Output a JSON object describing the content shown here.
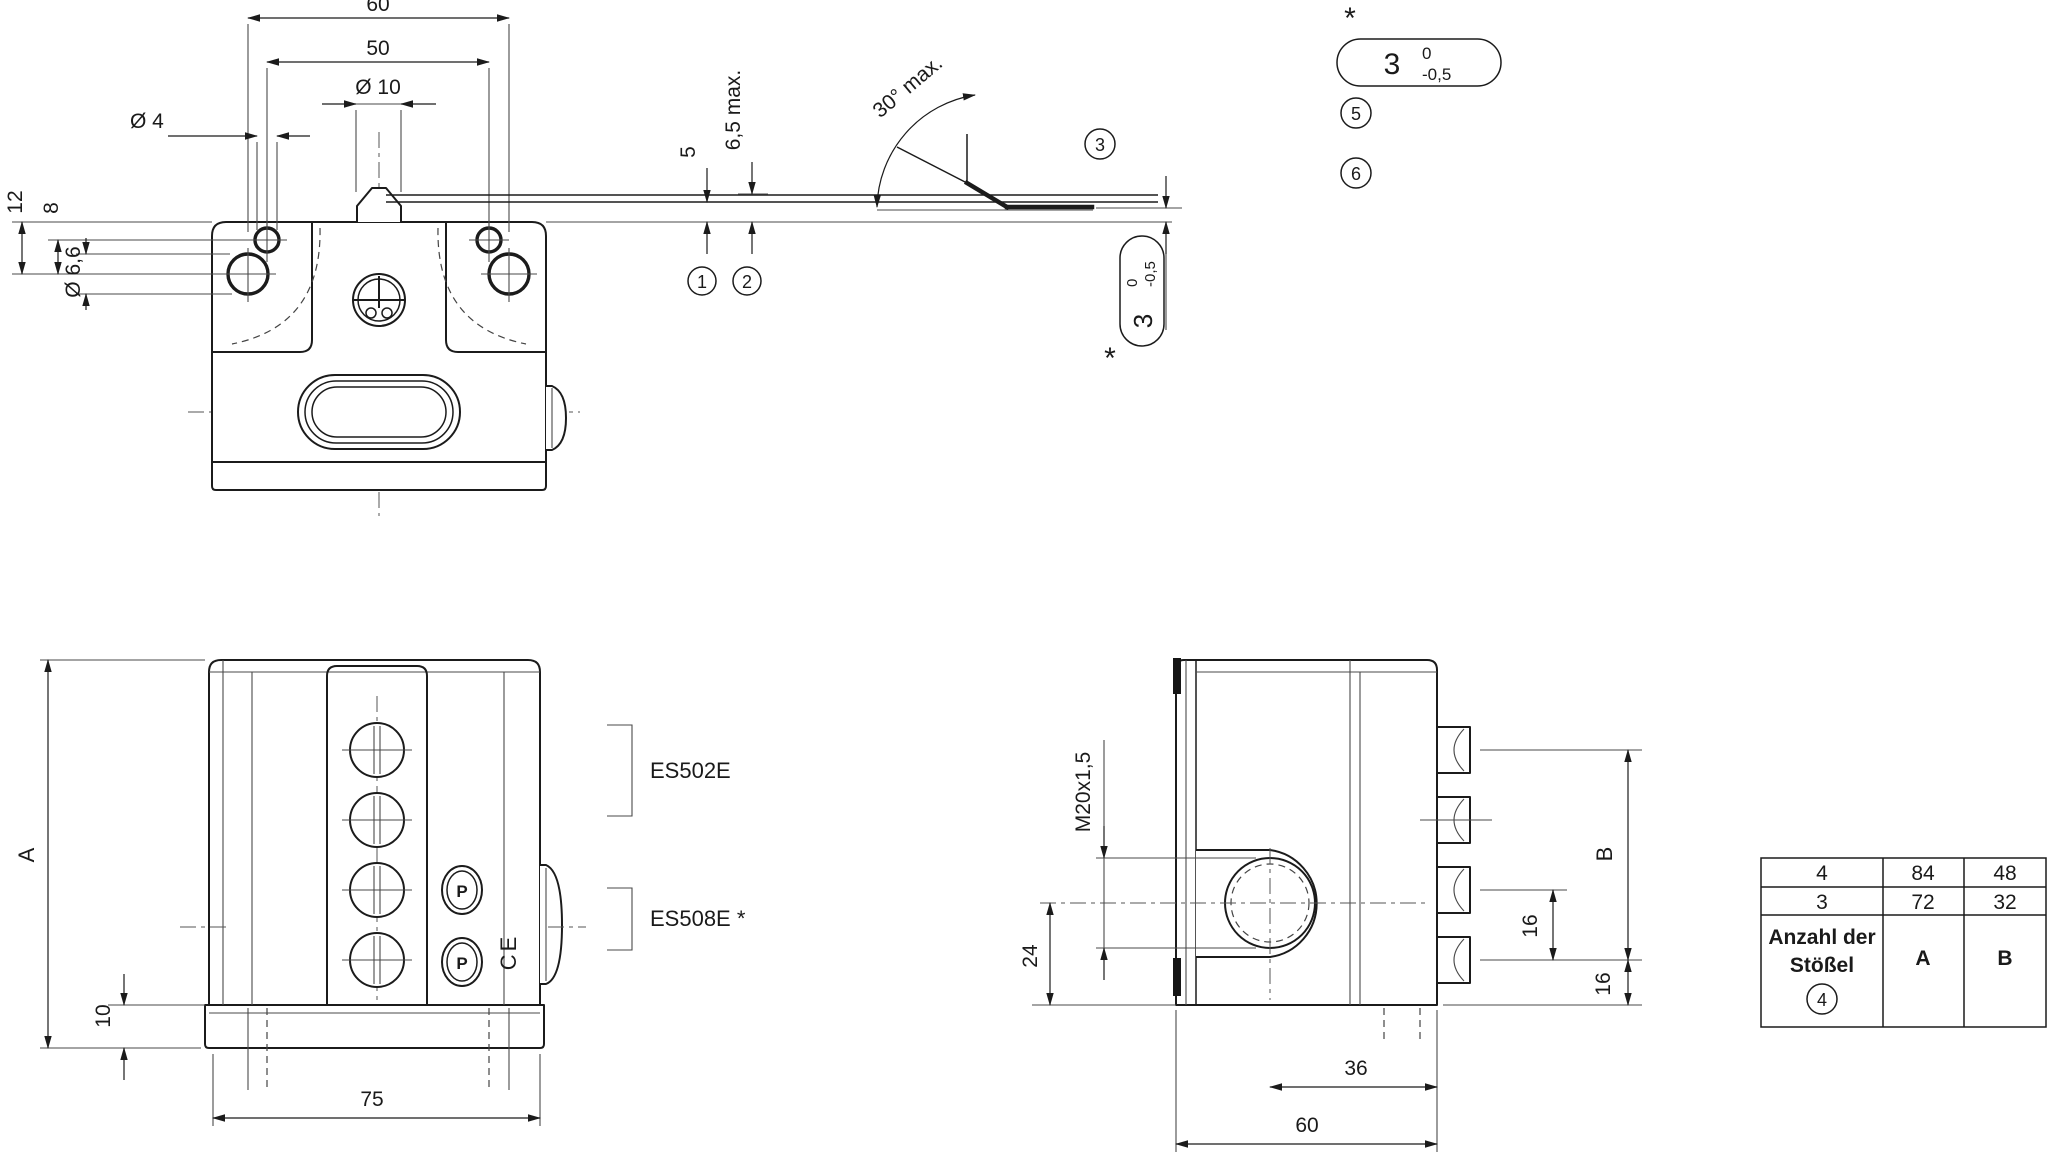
{
  "front_view": {
    "dim_60": "60",
    "dim_50": "50",
    "dim_d10": "Ø 10",
    "dim_d4": "Ø 4",
    "dim_12": "12",
    "dim_8": "8",
    "dim_d66": "Ø 6,6",
    "dim_5": "5",
    "dim_65": "6,5 max.",
    "angle": "30° max.",
    "note1": "1",
    "note2": "2",
    "note3": "3",
    "note5": "5",
    "note6": "6",
    "star": "*"
  },
  "tol": {
    "value": "3",
    "upper": "0",
    "lower": "-0,5"
  },
  "side_view": {
    "dim_A": "A",
    "dim_10": "10",
    "dim_75": "75",
    "model_a": "ES502E",
    "model_b": "ES508E *",
    "approval": "P",
    "ce": "CE"
  },
  "end_view": {
    "thread": "M20x1,5",
    "dim_24": "24",
    "dim_36": "36",
    "dim_60": "60",
    "dim_16a": "16",
    "dim_16b": "16",
    "dim_B": "B"
  },
  "table": {
    "rows": [
      {
        "plungers": "4",
        "a": "84",
        "b": "48"
      },
      {
        "plungers": "3",
        "a": "72",
        "b": "32"
      }
    ],
    "header_line1": "Anzahl der",
    "header_line2": "Stößel",
    "header_ref": "4",
    "col_a": "A",
    "col_b": "B"
  }
}
